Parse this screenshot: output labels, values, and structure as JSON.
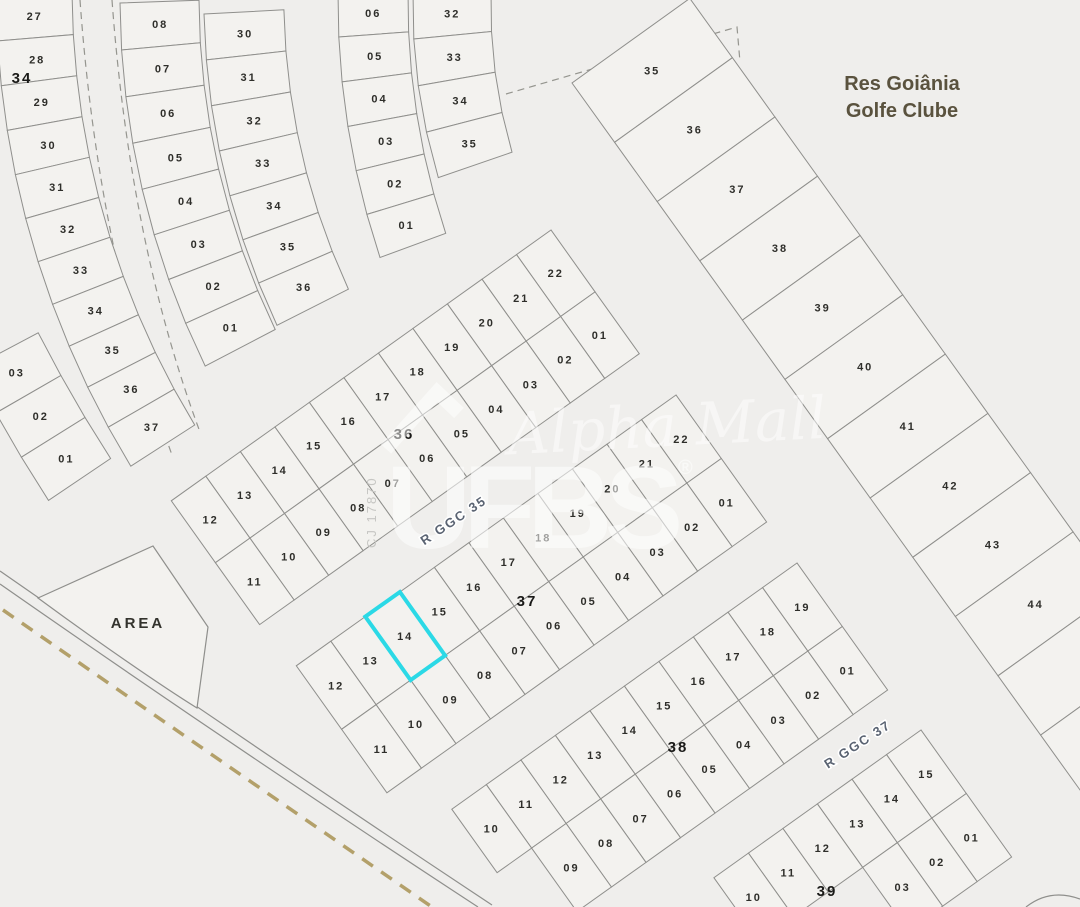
{
  "map_title": {
    "line1": "Res Goiânia",
    "line2": "Golfe Clube"
  },
  "area_label": "AREA",
  "streets": [
    {
      "name": "R GGC 35"
    },
    {
      "name": "R GGC 37"
    }
  ],
  "watermark": {
    "script": "Alpha Mall",
    "brand": "UFBS",
    "registered": "®",
    "code": "CJ 17870"
  },
  "highlight": {
    "block": "37",
    "lot": "14",
    "color": "#2BD9E6"
  },
  "colors": {
    "background": "#efeeec",
    "lot_fill": "#f3f2ef",
    "lot_line": "#8f8f8c",
    "lot_label": "#2e2e2a",
    "street_label": "#5a6372",
    "title": "#5a523e",
    "area_label": "#33332d",
    "boundary_dash_tan": "#b3a06a",
    "highlight": "#2BD9E6",
    "watermark": "#ffffff"
  },
  "fan_blocks": [
    {
      "block_label": "34",
      "label_pos": [
        22,
        83
      ],
      "start": [
        -4,
        -4
      ],
      "theta0": 88,
      "d_theta": -2.8,
      "lot_h": 45,
      "width": 76,
      "lots": [
        "27",
        "28",
        "29",
        "30",
        "31",
        "32",
        "33",
        "34",
        "35",
        "36",
        "37"
      ]
    },
    {
      "start": [
        120,
        3
      ],
      "theta0": 88,
      "d_theta": -3.2,
      "lot_h": 47,
      "width": 79,
      "lots": [
        "08",
        "07",
        "06",
        "05",
        "04",
        "03",
        "02",
        "01"
      ]
    },
    {
      "start": [
        204,
        14
      ],
      "theta0": 87,
      "d_theta": -3.4,
      "lot_h": 46,
      "width": 80,
      "lots": [
        "30",
        "31",
        "32",
        "33",
        "34",
        "35",
        "36"
      ]
    },
    {
      "start": [
        338,
        -8
      ],
      "theta0": 89,
      "d_theta": -3.2,
      "lot_h": 45,
      "width": 70,
      "lots": [
        "06",
        "05",
        "04",
        "03",
        "02",
        "01"
      ]
    },
    {
      "start": [
        413,
        -8
      ],
      "theta0": 89,
      "d_theta": -4.5,
      "lot_h": 47,
      "width": 78,
      "lots": [
        "32",
        "33",
        "34",
        "35"
      ]
    },
    {
      "start": [
        -28,
        368
      ],
      "theta0": 62,
      "d_theta": -2,
      "lot_h": 51,
      "width": 75,
      "lots": [
        "03",
        "02",
        "01"
      ]
    }
  ],
  "strip_blocks": [
    {
      "block_label": "36",
      "label_pos": [
        404,
        439
      ],
      "start": [
        551,
        230
      ],
      "row_angle": 144.5,
      "depth_angle": 54.5,
      "lot_w": 42.4,
      "depth": 76,
      "rows": [
        [
          "22",
          "21",
          "20",
          "19",
          "18",
          "17",
          "16",
          "15",
          "14",
          "13",
          "12"
        ],
        [
          "01",
          "02",
          "03",
          "04",
          "05",
          "06",
          "07",
          "08",
          "09",
          "10",
          "11"
        ]
      ]
    },
    {
      "block_label": "37",
      "label_pos": [
        527,
        606
      ],
      "start": [
        676,
        395
      ],
      "row_angle": 144.5,
      "depth_angle": 54.5,
      "lot_w": 42.4,
      "depth": 78,
      "rows": [
        [
          "22",
          "21",
          "20",
          "19",
          "18",
          "17",
          "16",
          "15",
          "14",
          "13",
          "12"
        ],
        [
          "01",
          "02",
          "03",
          "04",
          "05",
          "06",
          "07",
          "08",
          "09",
          "10",
          "11"
        ]
      ],
      "highlight": {
        "row": 0,
        "index": 8
      }
    },
    {
      "block_label": "38",
      "label_pos": [
        678,
        752
      ],
      "start": [
        797,
        563
      ],
      "row_angle": 144.5,
      "depth_angle": 54.5,
      "lot_w": 42.4,
      "depth": 78,
      "rows": [
        [
          "19",
          "18",
          "17",
          "16",
          "15",
          "14",
          "13",
          "12",
          "11",
          "10"
        ],
        [
          "01",
          "02",
          "03",
          "04",
          "05",
          "06",
          "07",
          "08",
          "09"
        ]
      ]
    },
    {
      "block_label": "39",
      "label_pos": [
        827,
        896
      ],
      "start": [
        921,
        730
      ],
      "row_angle": 144.5,
      "depth_angle": 54.5,
      "lot_w": 42.4,
      "depth": 78,
      "rows": [
        [
          "15",
          "14",
          "13",
          "12",
          "11",
          "10"
        ],
        [
          "01",
          "02",
          "03"
        ]
      ]
    },
    {
      "start": [
        572,
        83
      ],
      "row_angle": 54.3,
      "depth_angle": -35.7,
      "lot_w": 73,
      "depth": 145,
      "rows": [
        [
          "35",
          "36",
          "37",
          "38",
          "39",
          "40",
          "41",
          "42",
          "43",
          "44",
          "",
          ""
        ]
      ]
    }
  ]
}
